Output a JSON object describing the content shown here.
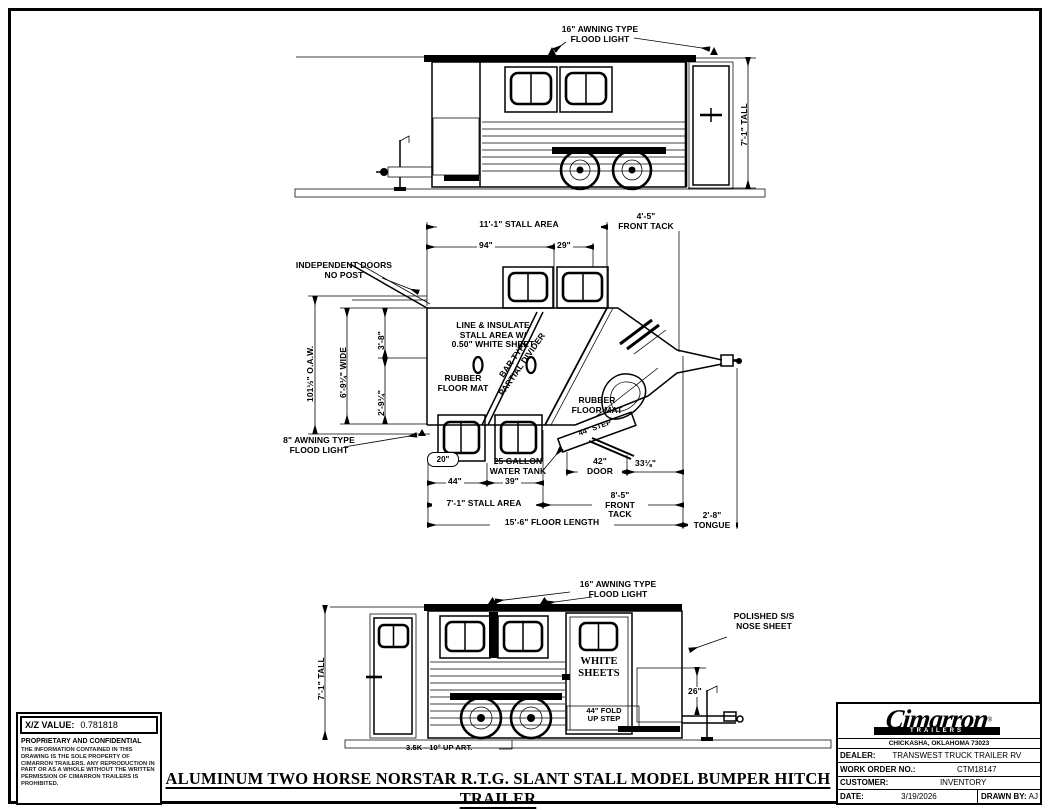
{
  "sheet": {
    "drawing_title": "ALUMINUM TWO HORSE NORSTAR R.T.G. SLANT STALL MODEL BUMPER HITCH TRAILER"
  },
  "top_view": {
    "flood_light_label": "16\" AWNING TYPE\nFLOOD LIGHT",
    "height_dim": "7'-1\" TALL"
  },
  "plan_view": {
    "stall_area_top_dim": "11'-1\" STALL AREA",
    "front_tack_top_dim": "4'-5\"\nFRONT TACK",
    "dim_94": "94\"",
    "dim_29": "29\"",
    "independent_doors_label": "INDEPENDENT DOORS\nNO POST",
    "overall_width_dim": "101½\" O.A.W.",
    "inner_width_dim": "6'-9¼\" WIDE",
    "dim_3_8": "3'-8\"",
    "dim_2_9_quarter": "2'-9¼\"",
    "line_insulate_note": "LINE & INSULATE\nSTALL AREA W/\n0.50\" WHITE SHEET",
    "divider_note": "BAR TYPE\nPARTIAL DIVIDER",
    "rubber_mat_note_1": "RUBBER\nFLOOR MAT",
    "rubber_mat_note_2": "RUBBER\nFLOOR MAT",
    "flood_light_label": "8\" AWNING TYPE\nFLOOD LIGHT",
    "dim_20": "20\"",
    "water_tank_note": "25 GALLON\nWATER TANK",
    "step_note": "44\" STEP",
    "door_dim": "42\"\nDOOR",
    "dim_33_eighth": "33⅛\"",
    "dim_44": "44\"",
    "dim_39": "39\"",
    "stall_area_bottom_dim": "7'-1\" STALL AREA",
    "front_tack_bottom_dim": "8'-5\"\nFRONT TACK",
    "floor_length_dim": "15'-6\" FLOOR LENGTH",
    "tongue_dim": "2'-8\"\nTONGUE"
  },
  "bottom_view": {
    "flood_light_label": "16\" AWNING TYPE\nFLOOD LIGHT",
    "height_dim": "7'-1\" TALL",
    "white_sheets_label": "WHITE\nSHEETS",
    "nose_sheet_label": "POLISHED S/S\nNOSE SHEET",
    "dim_26": "26\"",
    "fold_step_label": "44\" FOLD\nUP STEP",
    "axle_note": "3.5K - 10° UP ART."
  },
  "proprietary": {
    "xz_label": "X/Z VALUE:",
    "xz_value": "0.781818",
    "confidential_title": "PROPRIETARY AND CONFIDENTIAL",
    "confidential_text": "THE INFORMATION CONTAINED IN THIS DRAWING IS THE SOLE PROPERTY OF CIMARRON TRAILERS. ANY REPRODUCTION IN PART OR AS A WHOLE WITHOUT THE WRITTEN PERMISSION OF CIMARRON TRAILERS IS PROHIBITED."
  },
  "title_block": {
    "brand": "Cimarron",
    "brand_sub": "TRAILERS",
    "reg": "®",
    "address": "CHICKASHA, OKLAHOMA 73023",
    "dealer_label": "DEALER:",
    "dealer_value": "TRANSWEST TRUCK TRAILER RV",
    "work_order_label": "WORK ORDER NO.:",
    "work_order_value": "CTM18147",
    "customer_label": "CUSTOMER:",
    "customer_value": "INVENTORY",
    "date_label": "DATE:",
    "date_value": "3/19/2026",
    "drawn_by_label": "DRAWN BY:",
    "drawn_by_value": "AJ"
  }
}
